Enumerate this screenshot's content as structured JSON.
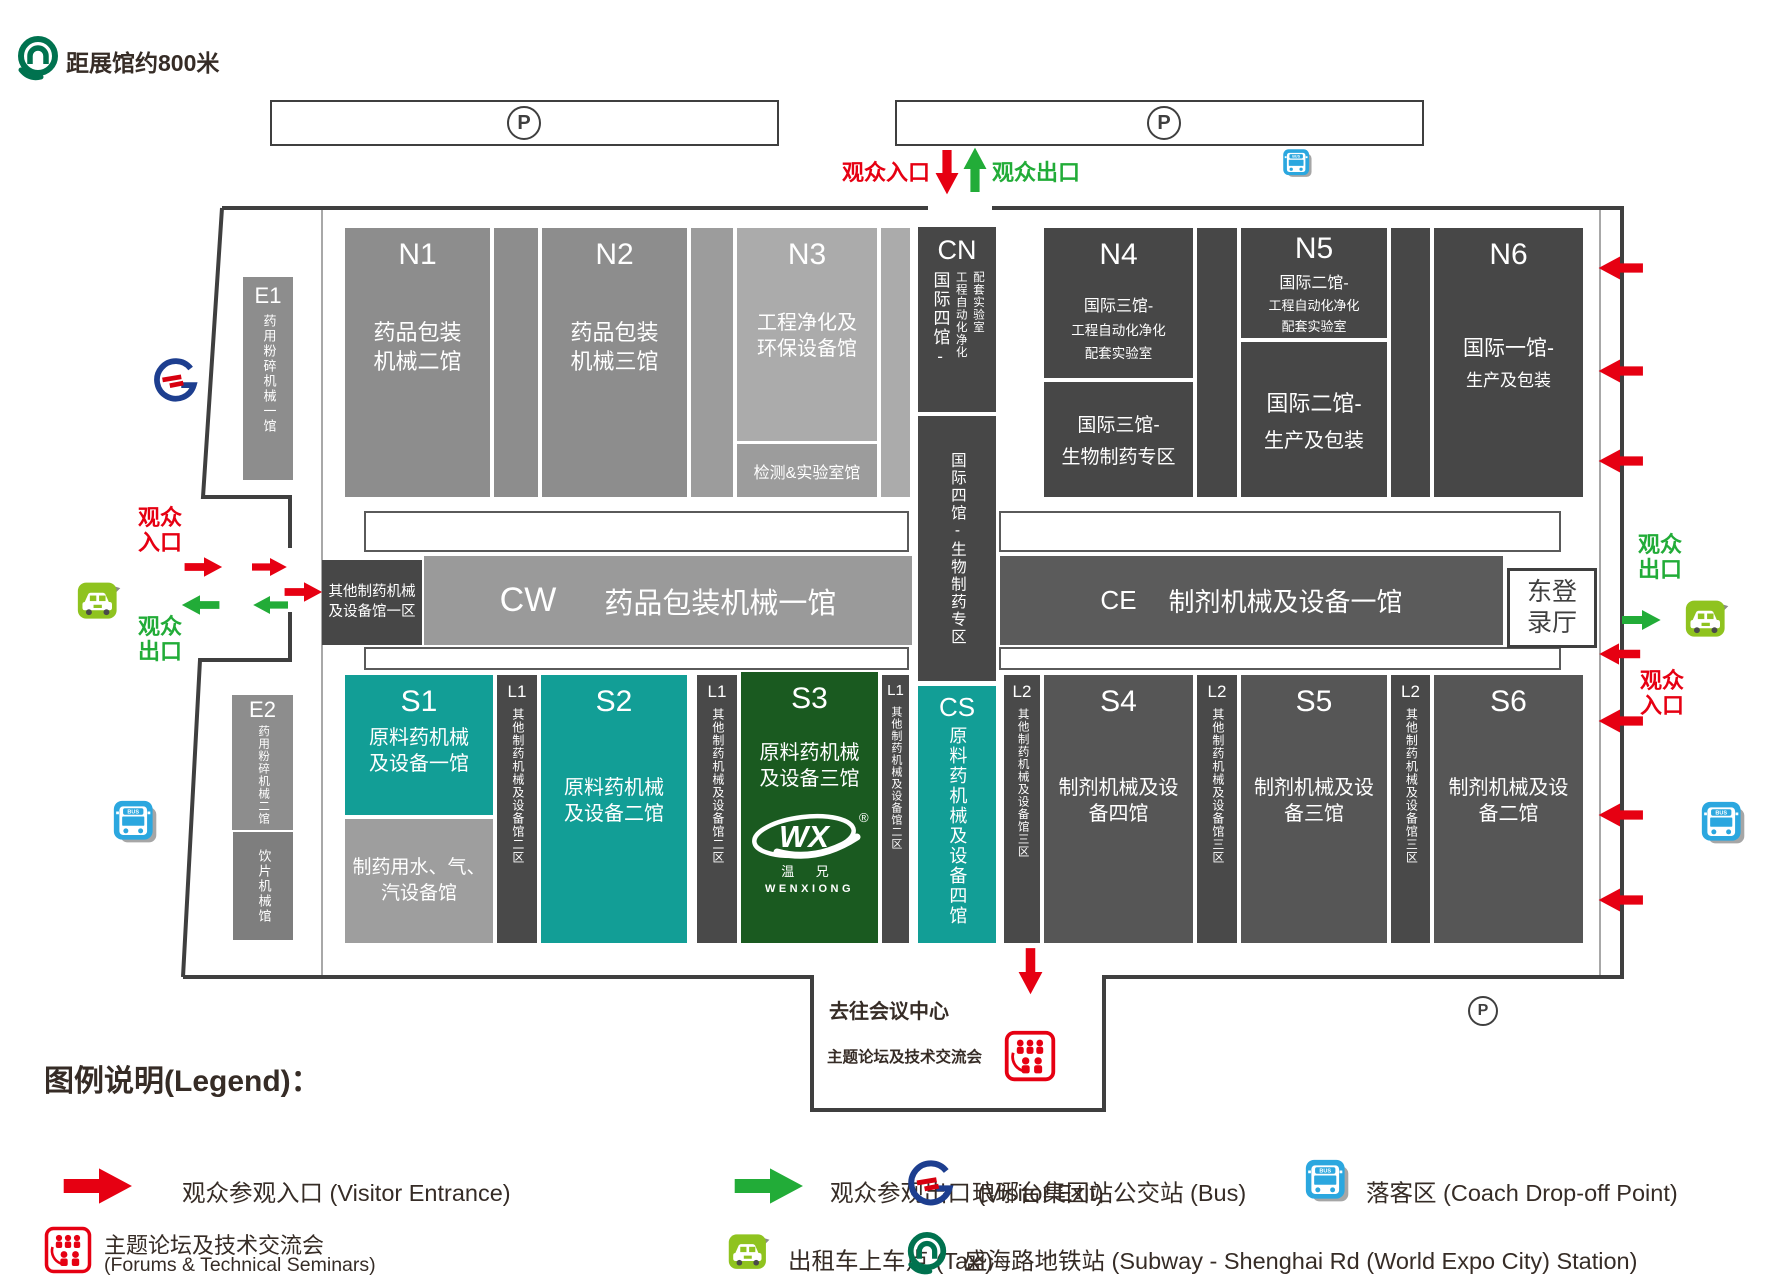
{
  "colors": {
    "red": "#e60012",
    "green": "#22ac38",
    "teal": "#129e96",
    "hall_dark": "#474747",
    "hall_medium": "#8d8d8d",
    "hall_light": "#ababab",
    "s_gray": "#565656",
    "s3_green": "#1a5a20",
    "taxi_green": "#8fc31f",
    "bus_blue": "#2ba7df",
    "wall": "#3f3f3f"
  },
  "header": {
    "distance_note": "距展馆约800米"
  },
  "parking": {
    "label": "P"
  },
  "gates": {
    "entrance": "观众入口",
    "exit": "观众出口"
  },
  "icons": {
    "bus_label": "BUS"
  },
  "halls": {
    "e1": {
      "id": "E1",
      "name": "药用粉碎机械一馆"
    },
    "e2": {
      "id": "E2",
      "name": "药用粉碎机械二馆"
    },
    "e2_sub": {
      "name": "饮片机械馆"
    },
    "n1": {
      "id": "N1",
      "name": "药品包装机械二馆"
    },
    "n2": {
      "id": "N2",
      "name": "药品包装机械三馆"
    },
    "n3": {
      "id": "N3",
      "name": "工程净化及环保设备馆"
    },
    "n3_lab": {
      "name": "检测&实验室馆"
    },
    "cn": {
      "id": "CN",
      "top_main": "国际四馆-",
      "top_sub1": "工程自动化净化",
      "top_sub2": "配套实验室",
      "bottom": "国际四馆-生物制药专区"
    },
    "n4": {
      "id": "N4",
      "top_line1": "国际三馆-",
      "top_line2": "工程自动化净化",
      "top_line3": "配套实验室",
      "bottom_line1": "国际三馆-",
      "bottom_line2": "生物制药专区"
    },
    "n5": {
      "id": "N5",
      "top_line1": "国际二馆-",
      "top_line2": "工程自动化净化",
      "top_line3": "配套实验室",
      "bottom_line1": "国际二馆-",
      "bottom_line2": "生产及包装"
    },
    "n6": {
      "id": "N6",
      "line1": "国际一馆-",
      "line2": "生产及包装"
    },
    "other_zone1": {
      "name": "其他制药机械及设备馆一区"
    },
    "cw": {
      "id": "CW",
      "name": "药品包装机械一馆"
    },
    "ce": {
      "id": "CE",
      "name": "制剂机械及设备一馆"
    },
    "east_hall": {
      "name": "东登录厅"
    },
    "s1": {
      "id": "S1",
      "name": "原料药机械及设备一馆",
      "sub": "制药用水、气、汽设备馆"
    },
    "l1": {
      "id": "L1",
      "name": "其他制药机械及设备馆二区"
    },
    "s2": {
      "id": "S2",
      "name": "原料药机械及设备二馆"
    },
    "s3": {
      "id": "S3",
      "name": "原料药机械及设备三馆",
      "logo_mark": "WX",
      "logo_reg": "®",
      "logo_cn": "温 兄",
      "logo_en": "WENXIONG"
    },
    "cs": {
      "id": "CS",
      "name": "原料药机械及设备四馆"
    },
    "l2": {
      "id": "L2",
      "name": "其他制药机械及设备馆三区"
    },
    "s4": {
      "id": "S4",
      "name": "制剂机械及设备四馆"
    },
    "s5": {
      "id": "S5",
      "name": "制剂机械及设备三馆"
    },
    "s6": {
      "id": "S6",
      "name": "制剂机械及设备二馆"
    }
  },
  "conference": {
    "line1": "去往会议中心",
    "line2": "主题论坛及技术交流会"
  },
  "legend": {
    "title": "图例说明(Legend)：",
    "entrance": "观众参观入口 (Visitor Entrance)",
    "exit": "观众参观出口 (Visitor Exit)",
    "bus": "琅琊台集团站公交站 (Bus)",
    "coach": "落客区 (Coach Drop-off Point)",
    "seminar_line1": "主题论坛及技术交流会",
    "seminar_line2": "(Forums & Technical Seminars)",
    "taxi": "出租车上车点 (Taxi)",
    "subway": "盛海路地铁站 (Subway - Shenghai Rd (World Expo City) Station)"
  }
}
